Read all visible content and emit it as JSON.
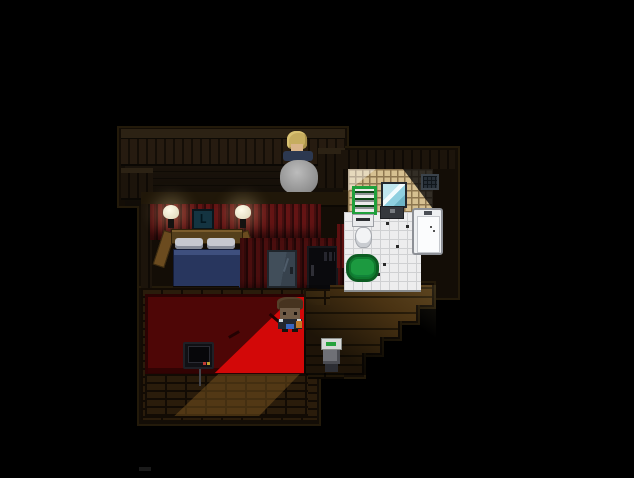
{
  "app": {
    "title": "Pixel-art RPG interior scene",
    "view": "top-down house interior on black letterbox background"
  },
  "scene": {
    "clock_glyph": "L",
    "rooms": [
      {
        "id": "balcony",
        "label": "wooden balcony with plank railing"
      },
      {
        "id": "bedroom",
        "label": "red-wallpapered bedroom with bed nook"
      },
      {
        "id": "carpet-room",
        "label": "lower room with red carpet lit by doorway light"
      },
      {
        "id": "bathroom",
        "label": "white-tiled bathroom with tan tiled wall"
      },
      {
        "id": "hallway",
        "label": "stepped wooden hallway descending to the right"
      }
    ],
    "objects": [
      {
        "id": "npc",
        "label": "blonde-haired person seated at round gray table"
      },
      {
        "id": "round-table",
        "label": "gray pedestal table with legs"
      },
      {
        "id": "wall-lamp-left",
        "label": "glowing wall lamp"
      },
      {
        "id": "wall-lamp-right",
        "label": "glowing wall lamp"
      },
      {
        "id": "wall-clock",
        "label": "dark teal wall clock/picture"
      },
      {
        "id": "bed",
        "label": "wood-frame bed, two pillows, blue blanket"
      },
      {
        "id": "window",
        "label": "dark blue-gray window"
      },
      {
        "id": "door",
        "label": "dark door with vent slits and handle"
      },
      {
        "id": "red-carpet",
        "label": "red carpet, dark in shadow, bright wedge in doorway light"
      },
      {
        "id": "player",
        "label": "player character, brown hair, orange pack, blue item"
      },
      {
        "id": "tv",
        "label": "black TV with red and yellow buttons and cable"
      },
      {
        "id": "towel-shelf",
        "label": "green shelf stacked with towels"
      },
      {
        "id": "toilet",
        "label": "white toilet with tank"
      },
      {
        "id": "mirror",
        "label": "blue mirror with shine"
      },
      {
        "id": "sink",
        "label": "dark sink under mirror"
      },
      {
        "id": "bathtub",
        "label": "white bathtub with faucet"
      },
      {
        "id": "bath-rug",
        "label": "green oval bath rug"
      },
      {
        "id": "vent",
        "label": "dark wall vent grid"
      },
      {
        "id": "floor-device",
        "label": "small white box with green stripe on dark stand"
      }
    ],
    "palette": {
      "background": "#000000",
      "wood_dark": "#1d150c",
      "wood_plank": "#4a3313",
      "red_wall": "#641414",
      "carpet_dark": "#4e0606",
      "carpet_lit": "#d30808",
      "tile_white": "#ededee",
      "tile_tan": "#d6c091",
      "rug_green": "#1c9a40",
      "shelf_green": "#1fa03c",
      "blanket_blue": "#28365e",
      "mirror_blue": "#8fd0e0",
      "npc_hair": "#c6ad5f",
      "player_pack_orange": "#c07a28",
      "player_item_blue": "#3a66c0"
    }
  }
}
